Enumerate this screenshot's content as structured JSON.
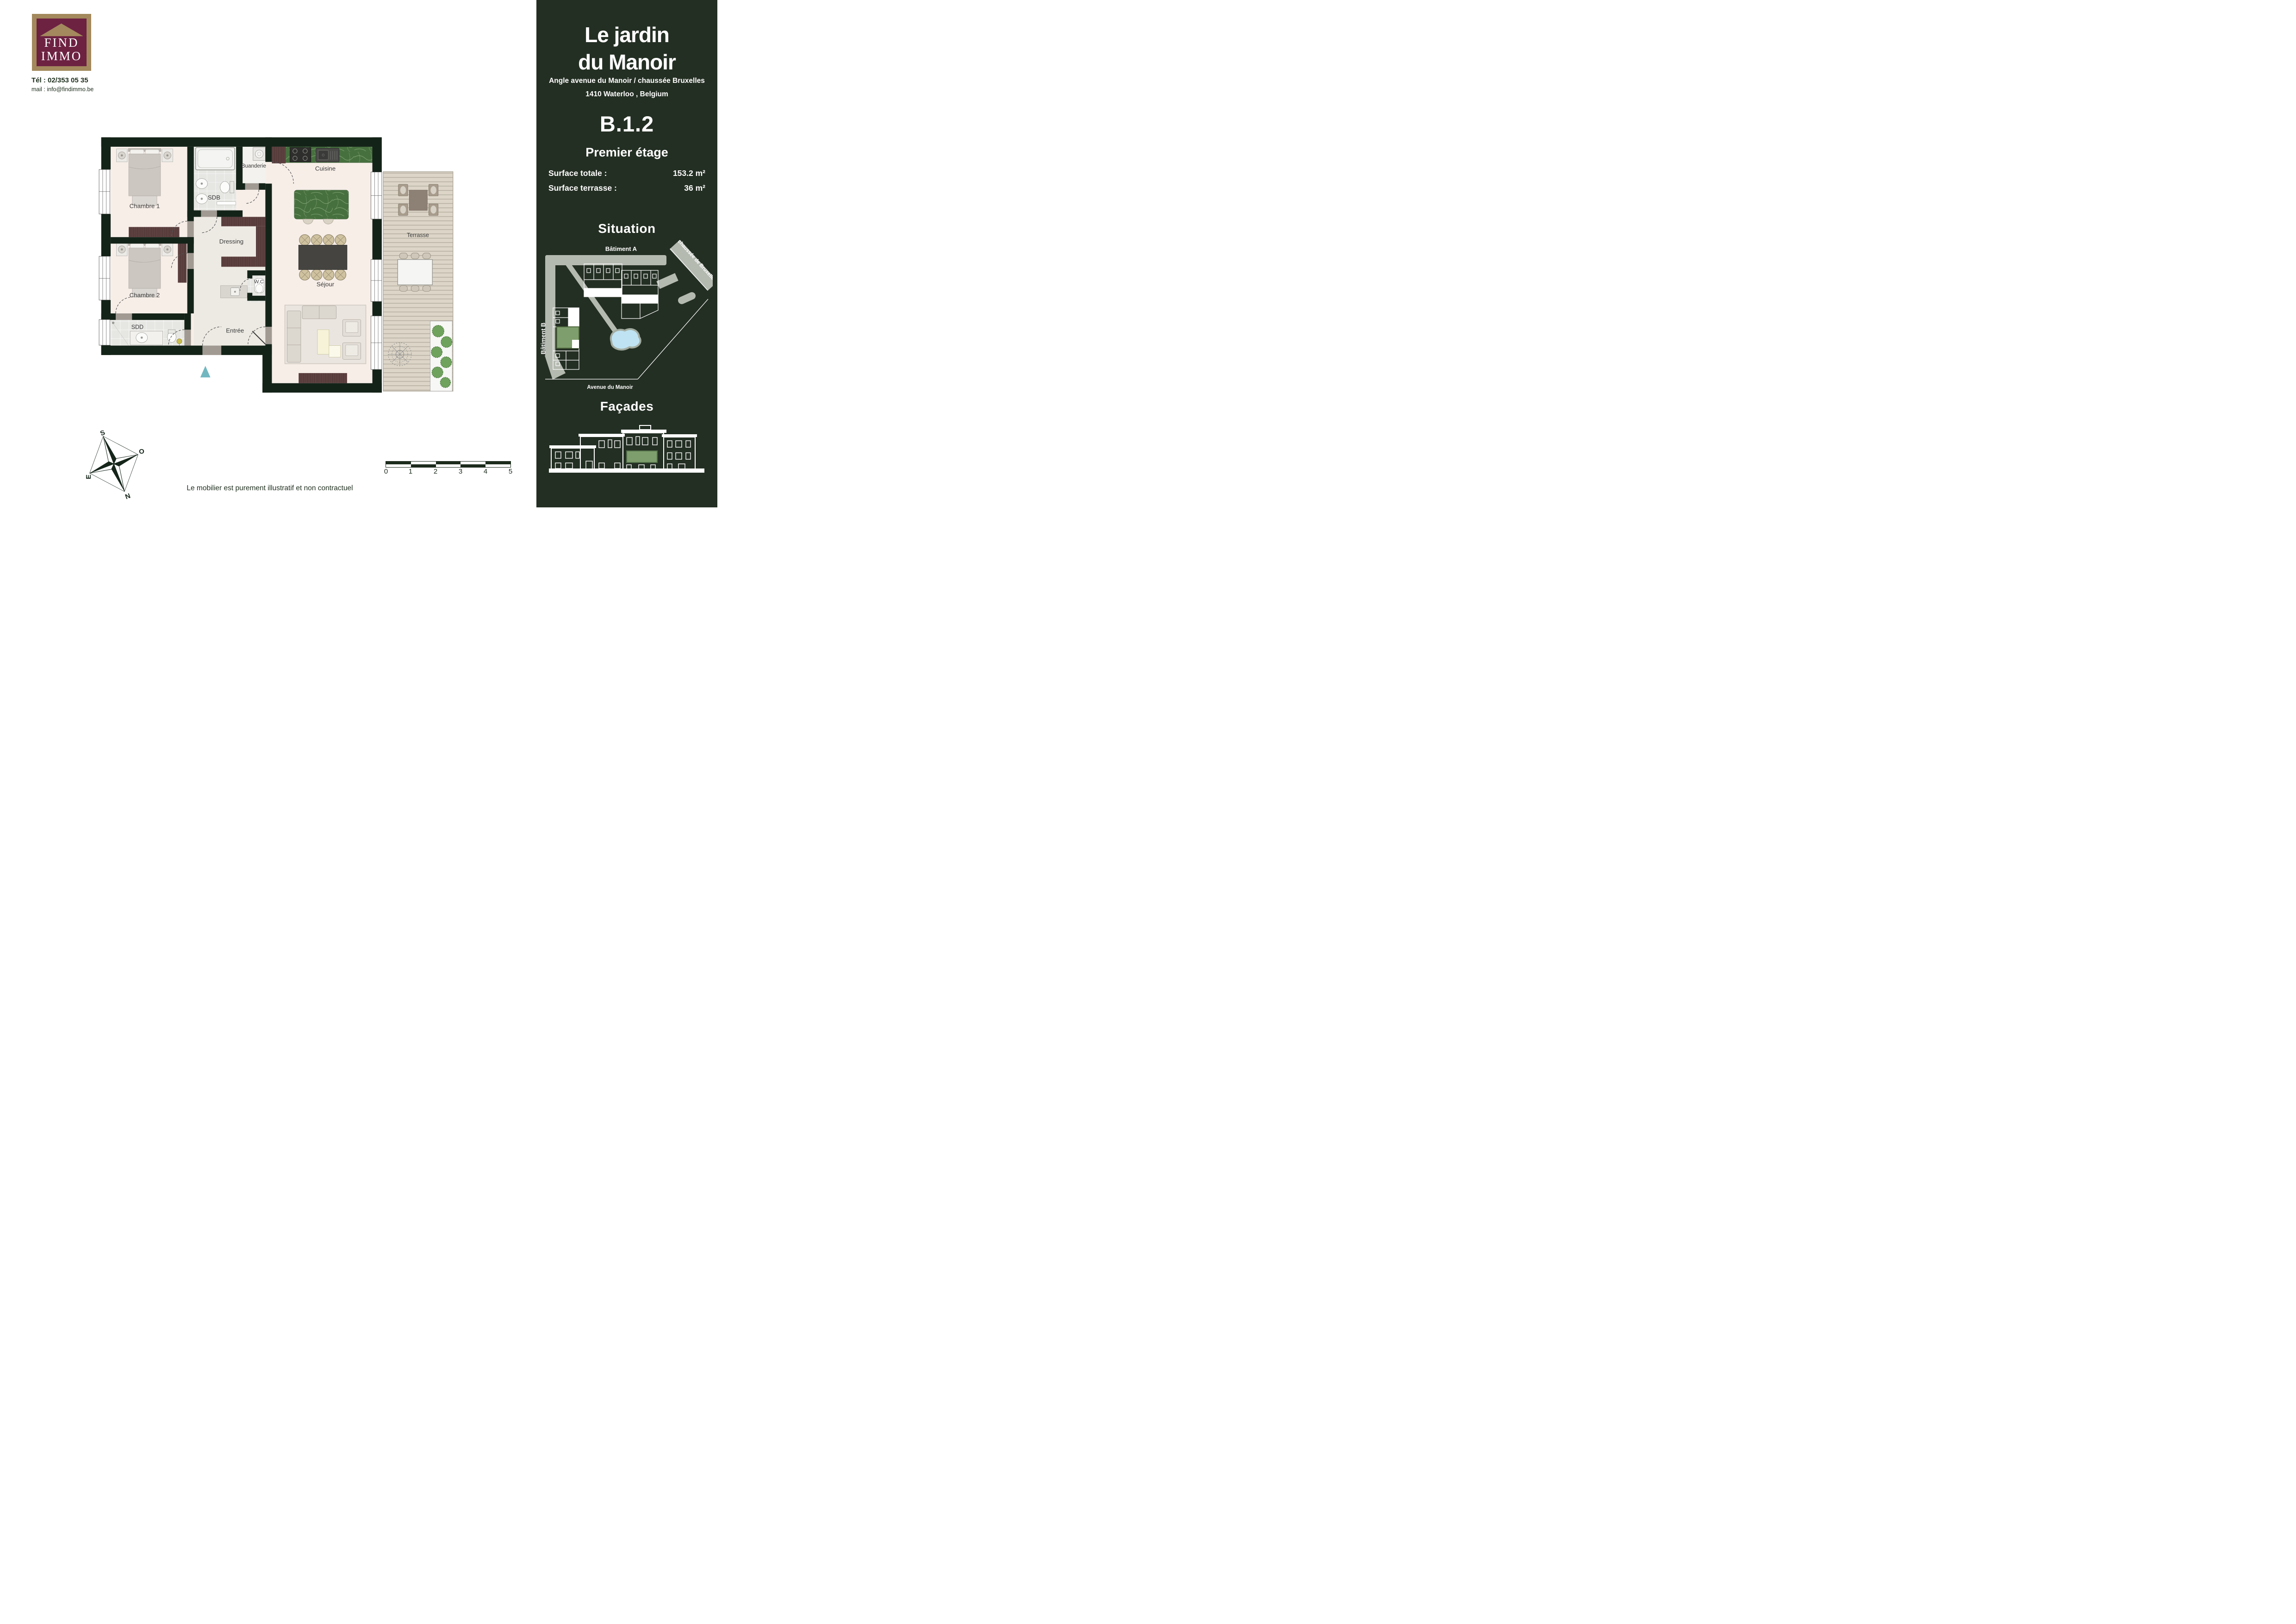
{
  "brand": {
    "logo_line1": "FIND",
    "logo_line2": "IMMO",
    "phone": "Tél : 02/353 05 35",
    "email": "mail : info@findimmo.be"
  },
  "panel": {
    "project_title_line1": "Le jardin",
    "project_title_line2": "du Manoir",
    "address_line1": "Angle avenue du Manoir / chaussée Bruxelles",
    "address_line2": "1410 Waterloo , Belgium",
    "unit": "B.1.2",
    "floor": "Premier étage",
    "surface_total_label": "Surface totale :",
    "surface_total_value": "153.2 m²",
    "surface_terrace_label": "Surface terrasse :",
    "surface_terrace_value": "36 m²",
    "situation_heading": "Situation",
    "situation_map": {
      "batiment_a": "Bâtiment A",
      "batiment_b": "Bâtiment B",
      "road_diagonal": "chaussée de Bruxelles",
      "road_bottom": "Avenue du Manoir"
    },
    "facades_heading": "Façades"
  },
  "floorplan": {
    "rooms": {
      "chambre1": "Chambre 1",
      "sdb": "SDB",
      "buanderie": "Buanderie",
      "cuisine": "Cuisine",
      "dressing": "Dressing",
      "chambre2": "Chambre 2",
      "wc": "W.C",
      "sdd": "SDD",
      "entree": "Entrée",
      "sejour": "Séjour",
      "terrasse": "Terrasse"
    }
  },
  "compass": {
    "south": "S",
    "west": "O",
    "east": "E",
    "north": "N"
  },
  "scale_bar": {
    "labels": [
      "0",
      "1",
      "2",
      "3",
      "4",
      "5"
    ]
  },
  "disclaimer": "Le mobilier est purement illustratif et non contractuel",
  "colors": {
    "panel_green": "#242f23",
    "wall_green": "#142318",
    "floor_cream": "#f7eee8",
    "highlight_green": "#7e9e6d",
    "pond_blue": "#bfe3f2",
    "road_gray": "#b5bab1",
    "logo_maroon": "#6d2242",
    "logo_tan": "#a3895d",
    "entrance_teal": "#72b7c0"
  }
}
